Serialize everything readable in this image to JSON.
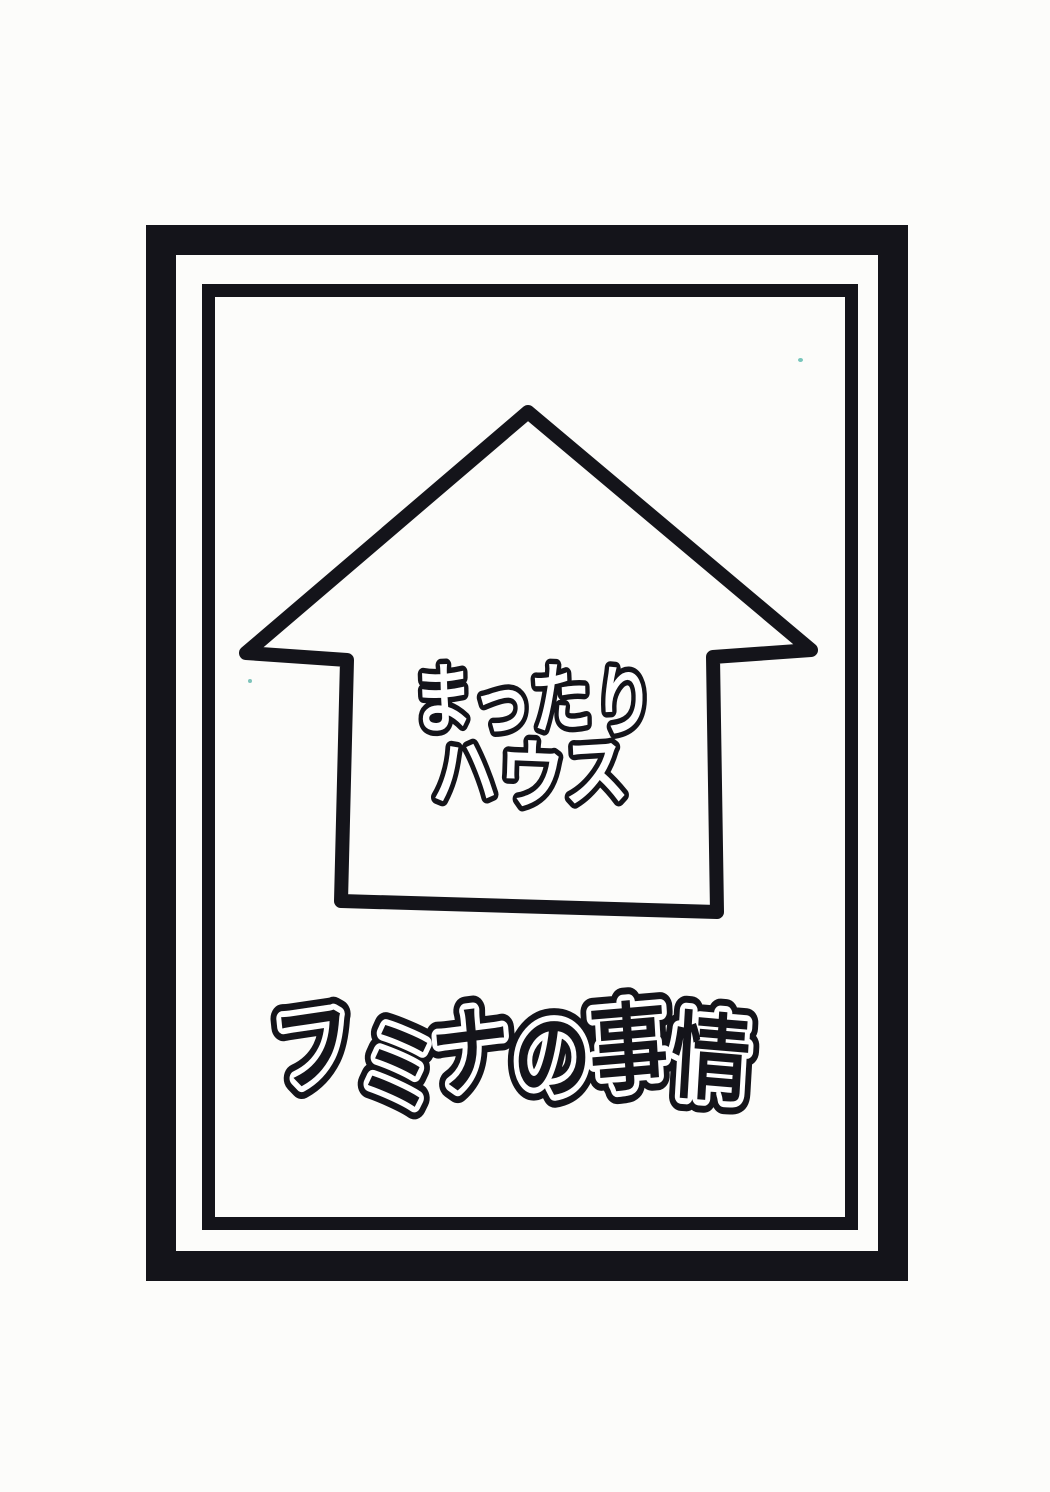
{
  "page": {
    "background": "#fcfcfa",
    "ink": "#14141a"
  },
  "cover": {
    "house_sign": {
      "line1": "まったり",
      "line2": "ハウス"
    },
    "title": "フミナの事情"
  },
  "icons": {
    "house": "hand-drawn house / upward-arrow outline enclosing the sign text"
  }
}
